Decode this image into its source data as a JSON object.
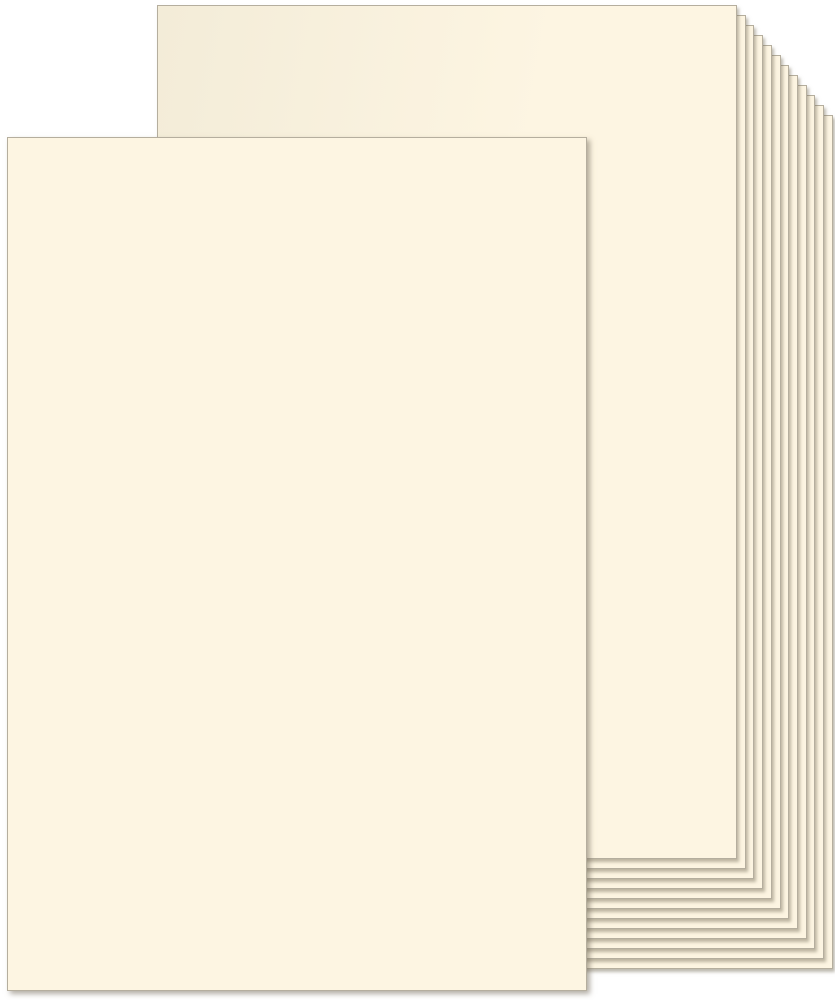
{
  "scene": {
    "description": "Product photo of a stack of blank ivory cream cardstock paper sheets fanned toward the upper right, with one sheet pulled out to the front lower left. No text is visible.",
    "background_color": "#ffffff",
    "paper_color": "#fdf5e2",
    "paper_shade_color": "#f3ecd8",
    "paper_edge_color": "#b5ae9e",
    "shadow_color": "rgba(125,117,98,0.50)",
    "front_shadow_color": "rgba(118,110,92,0.55)",
    "back_stack": {
      "sheet_count": 12,
      "first_sheet": {
        "left": 157,
        "top": 5,
        "width": 580,
        "height": 854
      },
      "offset_per_sheet": {
        "dx": 8.7,
        "dy": 10
      }
    },
    "front_sheet": {
      "left": 7,
      "top": 137,
      "width": 580,
      "height": 854
    }
  }
}
